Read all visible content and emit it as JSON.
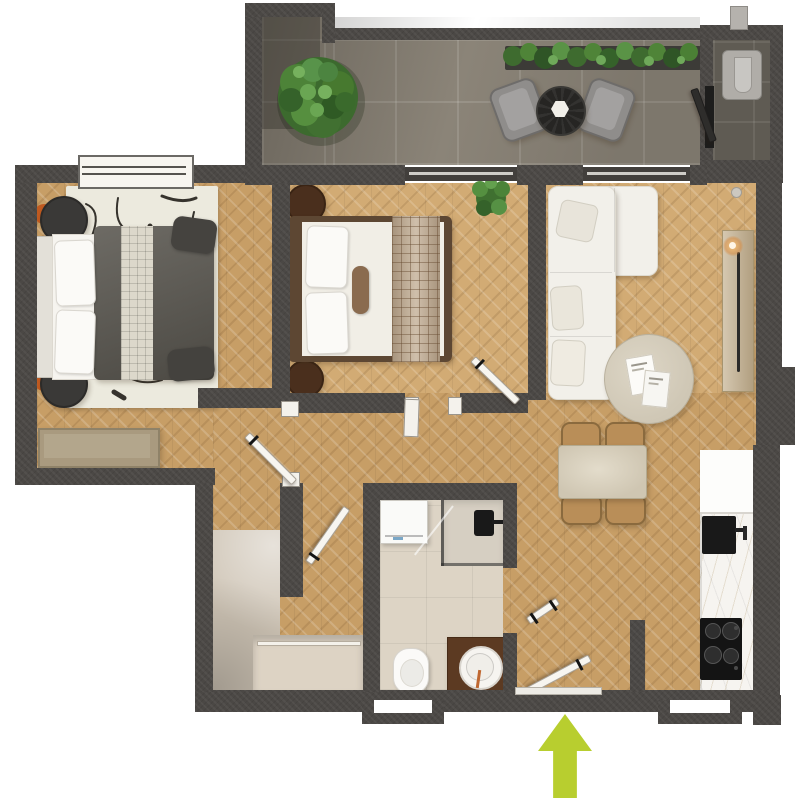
{
  "scene": {
    "description": "3D top-down rendered floor plan of a two-bedroom apartment with balcony terrace",
    "canvas": {
      "width": 800,
      "height": 800
    },
    "background": "#ffffff"
  },
  "palette": {
    "wall": "#4b4845",
    "floor_wood": "#c79e66",
    "floor_wood_light": "#d2ab74",
    "balcony_tile": "#8b8478",
    "utility_tile": "#5f5b53",
    "bathroom_tile": "#ddd4c5",
    "closet_beige": "#cfc5b6",
    "white_fabric": "#f2f0ea",
    "dark_bedding": "#59564f",
    "walnut_brown": "#5d4733",
    "chair_tan": "#b98e58",
    "marble_white": "#f6f4f0",
    "appliance_black": "#161616",
    "foliage_green": "#4c7c39",
    "accent_orange": "#c05a20",
    "entrance_arrow": "#b8ce2f"
  },
  "rooms": {
    "balcony": {
      "label": "Balcony terrace",
      "floor": "stone tile"
    },
    "utility": {
      "label": "Utility niche with water heater",
      "floor": "dark tile"
    },
    "bedroom_main": {
      "label": "Main bedroom",
      "floor": "herringbone wood"
    },
    "bedroom_second": {
      "label": "Second bedroom",
      "floor": "herringbone wood"
    },
    "living": {
      "label": "Living room",
      "floor": "herringbone wood"
    },
    "dining": {
      "label": "Dining area",
      "floor": "herringbone wood"
    },
    "kitchen": {
      "label": "Kitchen run",
      "floor": "herringbone wood"
    },
    "bathroom": {
      "label": "Bathroom",
      "floor": "beige tile"
    },
    "hall": {
      "label": "Entry hall with wardrobe",
      "floor": "herringbone wood"
    }
  },
  "furniture": {
    "balcony": [
      "potted tree",
      "flower planter",
      "two lounge chairs",
      "round bistro table"
    ],
    "bedroom_main": [
      "double bed with dark duvet",
      "two round nightstands",
      "abstract rug",
      "storage bench"
    ],
    "bedroom_second": [
      "double bed with white duvet",
      "two round nightstands",
      "potted plant"
    ],
    "living": [
      "white corner sofa",
      "round coffee table",
      "wooden console with candle"
    ],
    "dining": [
      "stone dining table",
      "four wooden chairs"
    ],
    "kitchen": [
      "fridge cabinet",
      "black sink",
      "black cooktop",
      "marble counter"
    ],
    "bathroom": [
      "washing machine",
      "walk-in shower",
      "toilet",
      "wooden vanity with round basin"
    ],
    "hall": [
      "built-in wardrobe"
    ]
  },
  "entrance": {
    "indicator": "lime arrow",
    "direction": "up",
    "color": "#b8ce2f"
  }
}
